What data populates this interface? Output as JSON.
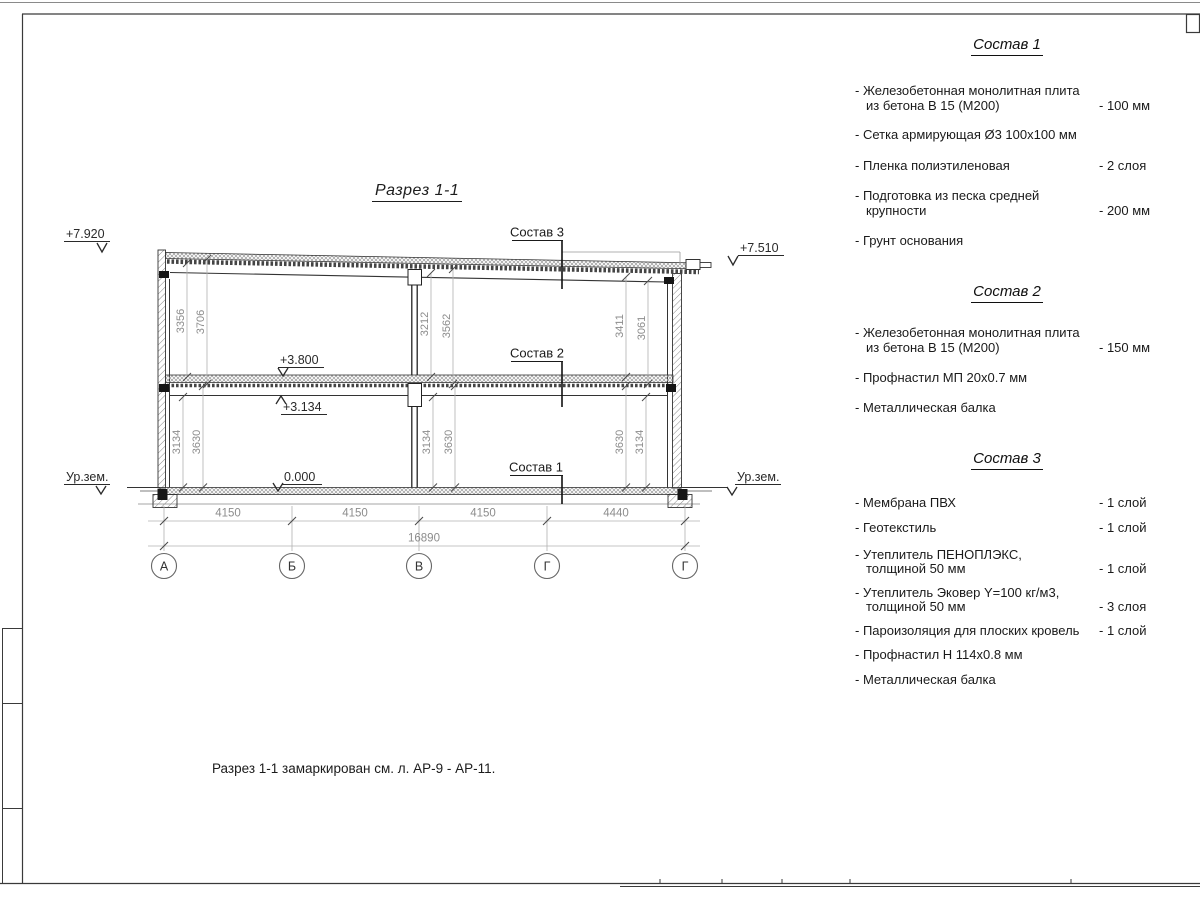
{
  "title": "Разрез 1-1",
  "note": "Разрез 1-1 замаркирован см. л. АР-9 - АР-11.",
  "section": {
    "levels": {
      "topLeft": "+7.920",
      "topRight": "+7.510",
      "floor2": "+3.800",
      "beam": "+3.134",
      "zero": "0.000",
      "groundLeft": "Ур.зем.",
      "groundRight": "Ур.зем."
    },
    "callouts": {
      "c3": "Состав 3",
      "c2": "Состав 2",
      "c1": "Состав 1"
    },
    "vdims": {
      "upperLeft": [
        "3356",
        "3706"
      ],
      "upperMid": [
        "3212",
        "3562"
      ],
      "upperRight": [
        "3411",
        "3061"
      ],
      "lowerLeft": [
        "3134",
        "3630"
      ],
      "lowerMid": [
        "3134",
        "3630"
      ],
      "lowerRight": [
        "3630",
        "3134"
      ]
    },
    "hdims": {
      "spans": [
        "4150",
        "4150",
        "4150",
        "4440"
      ],
      "total": "16890"
    },
    "axes": [
      "А",
      "Б",
      "В",
      "Г",
      "Г"
    ]
  },
  "panel": {
    "sections": [
      {
        "title": "Состав 1",
        "items": [
          {
            "l1": "- Железобетонная  монолитная плита",
            "l2": "из бетона В 15 (М200)",
            "val": "- 100 мм"
          },
          {
            "l1": "- Сетка армирующая Ø3 100х100 мм",
            "l2": "",
            "val": ""
          },
          {
            "l1": "- Пленка полиэтиленовая",
            "l2": "",
            "val": "- 2 слоя"
          },
          {
            "l1": "- Подготовка из песка средней",
            "l2": "крупности",
            "val": "- 200 мм"
          },
          {
            "l1": "- Грунт основания",
            "l2": "",
            "val": ""
          }
        ]
      },
      {
        "title": "Состав 2",
        "items": [
          {
            "l1": "- Железобетонная  монолитная плита",
            "l2": "из бетона В 15 (М200)",
            "val": "- 150 мм"
          },
          {
            "l1": "- Профнастил МП 20х0.7 мм",
            "l2": "",
            "val": ""
          },
          {
            "l1": "- Металлическая балка",
            "l2": "",
            "val": ""
          }
        ]
      },
      {
        "title": "Состав 3",
        "items": [
          {
            "l1": "- Мембрана ПВХ",
            "l2": "",
            "val": "- 1 слой"
          },
          {
            "l1": "- Геотекстиль",
            "l2": "",
            "val": "- 1 слой"
          },
          {
            "l1": "- Утеплитель ПЕНОПЛЭКС,",
            "l2": "толщиной 50 мм",
            "val": "- 1 слой"
          },
          {
            "l1": "- Утеплитель Эковер Y=100 кг/м3,",
            "l2": "толщиной 50 мм",
            "val": "- 3 слоя"
          },
          {
            "l1": "- Пароизоляция для плоских кровель",
            "l2": "",
            "val": "- 1 слой"
          },
          {
            "l1": "- Профнастил Н 114х0.8 мм",
            "l2": "",
            "val": ""
          },
          {
            "l1": "- Металлическая балка",
            "l2": "",
            "val": ""
          }
        ]
      }
    ]
  }
}
